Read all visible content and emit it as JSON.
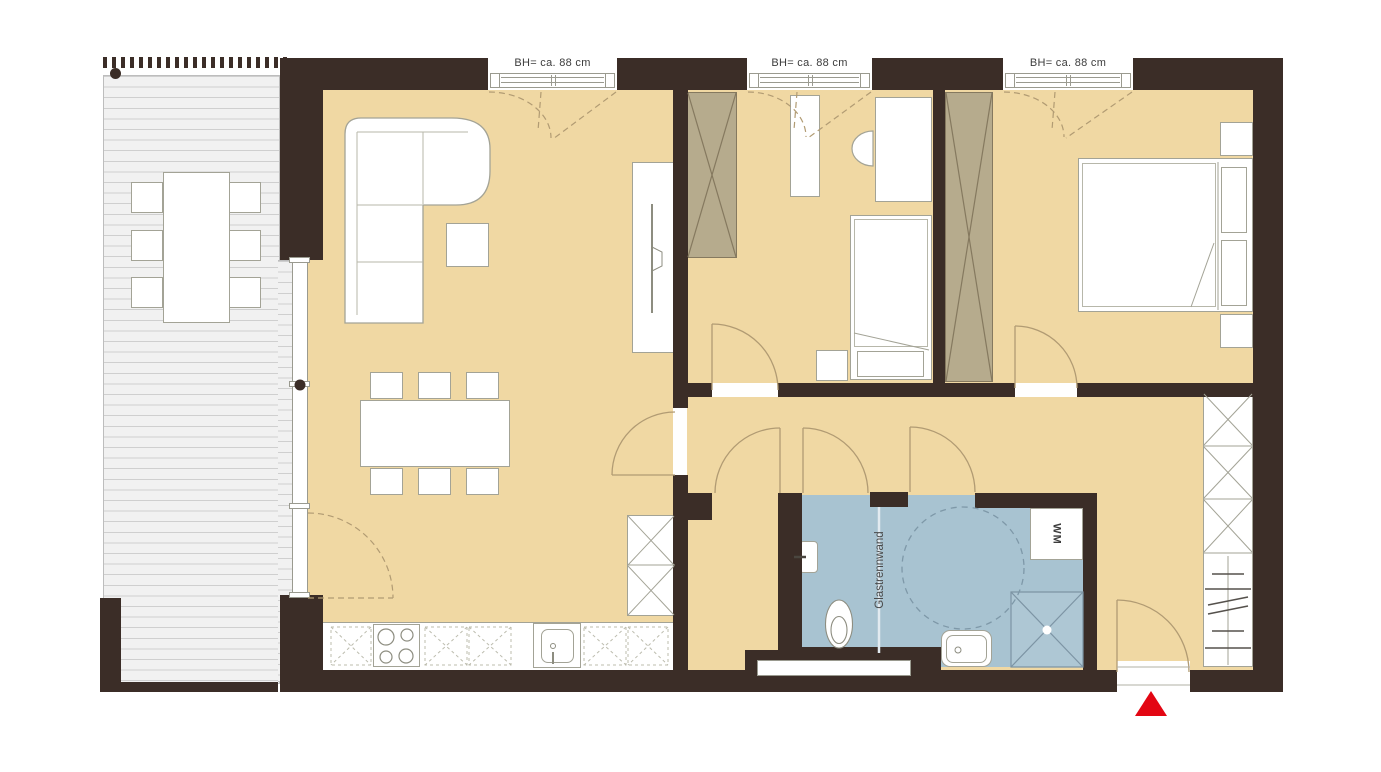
{
  "document": {
    "type": "floor-plan",
    "description": "apartment floor plan with terrace, living room, two bedrooms, bathroom and entrance"
  },
  "colors": {
    "wall": "#3b2d27",
    "room_floor": "#f0d8a3",
    "bathroom_floor": "#a8c3d1",
    "wardrobe_fill": "#b6ab8d",
    "door_swing": "#b19b73",
    "furniture_line": "#a3a396",
    "deck_line": "#cfcfcf",
    "entrance_marker": "#e30613",
    "text": "#3c3c3c"
  },
  "windows": {
    "items": [
      {
        "id": "window-1",
        "label": "BH= ca. 88 cm"
      },
      {
        "id": "window-2",
        "label": "BH= ca. 88 cm"
      },
      {
        "id": "window-3",
        "label": "BH= ca. 88 cm"
      }
    ]
  },
  "bathroom": {
    "partition_label": "Glastrennwand",
    "washing_machine_label": "WM"
  }
}
